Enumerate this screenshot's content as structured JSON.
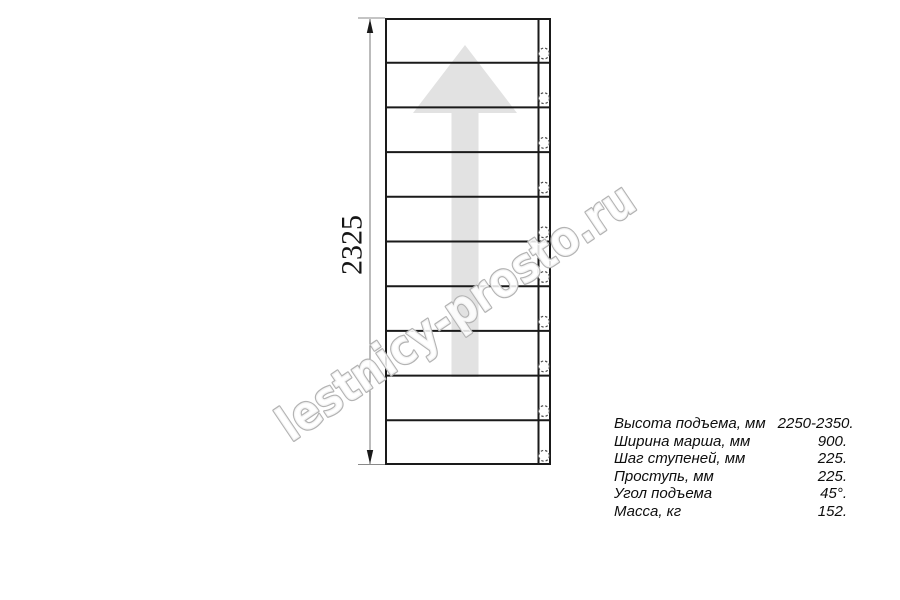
{
  "drawing": {
    "dimension_label": "2325",
    "steps_count": 10,
    "watermark_text": "lestnicy-prosto.ru",
    "colors": {
      "line": "#1a1a1a",
      "dimension_line": "#777777",
      "extension_line": "#8a8a8a",
      "arrow_fill": "#e2e2e2",
      "watermark_outline": "#b3b3b3",
      "circle_stroke": "#4a4a4a"
    }
  },
  "specs": {
    "rows": [
      {
        "label": "Высота подъема, мм",
        "value": "2250-2350."
      },
      {
        "label": "Ширина марша, мм",
        "value": "900."
      },
      {
        "label": "Шаг ступеней, мм",
        "value": "225."
      },
      {
        "label": "Проступь, мм",
        "value": "225."
      },
      {
        "label": "Угол подъема",
        "value": "45°."
      },
      {
        "label": "Масса, кг",
        "value": "152."
      }
    ]
  }
}
